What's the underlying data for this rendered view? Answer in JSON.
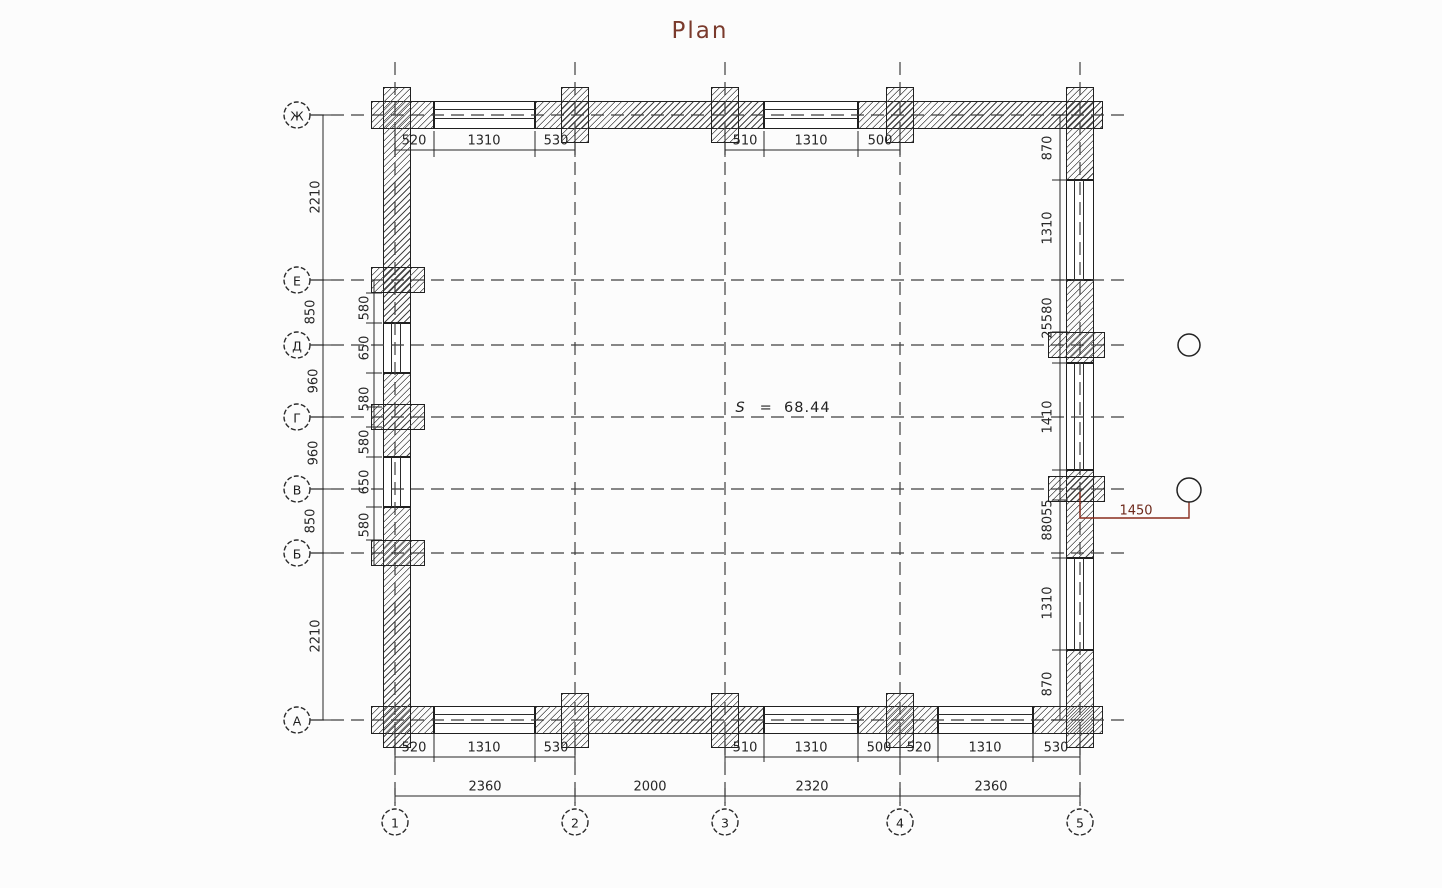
{
  "title": "Plan",
  "area": {
    "prefix": "S",
    "rest": "=  68.44"
  },
  "axes": {
    "rows": [
      "Ж",
      "Е",
      "Д",
      "Г",
      "В",
      "Б",
      "А"
    ],
    "cols": [
      "1",
      "2",
      "3",
      "4",
      "5"
    ]
  },
  "dims": {
    "top": [
      "520",
      "1310",
      "530",
      "510",
      "1310",
      "500"
    ],
    "bottom": [
      "520",
      "1310",
      "530",
      "510",
      "1310",
      "500",
      "520",
      "1310",
      "530"
    ],
    "overall": [
      "2360",
      "2000",
      "2320",
      "2360"
    ],
    "left_outer": [
      "2210",
      "850",
      "960",
      "960",
      "850",
      "2210"
    ],
    "left_inner": [
      "580",
      "650",
      "580",
      "580",
      "650",
      "580"
    ],
    "right_inner": [
      "870",
      "1310",
      "25580",
      "1410",
      "88055",
      "1310",
      "870"
    ],
    "leader": "1450"
  },
  "colors": {
    "ink": "#2a2a2a",
    "hatch": "#454545",
    "axis_line": "#3f3f3f",
    "accent_red": "#8a2c1d",
    "title_color": "#7a3a2c",
    "background": "#fcfcfc"
  }
}
